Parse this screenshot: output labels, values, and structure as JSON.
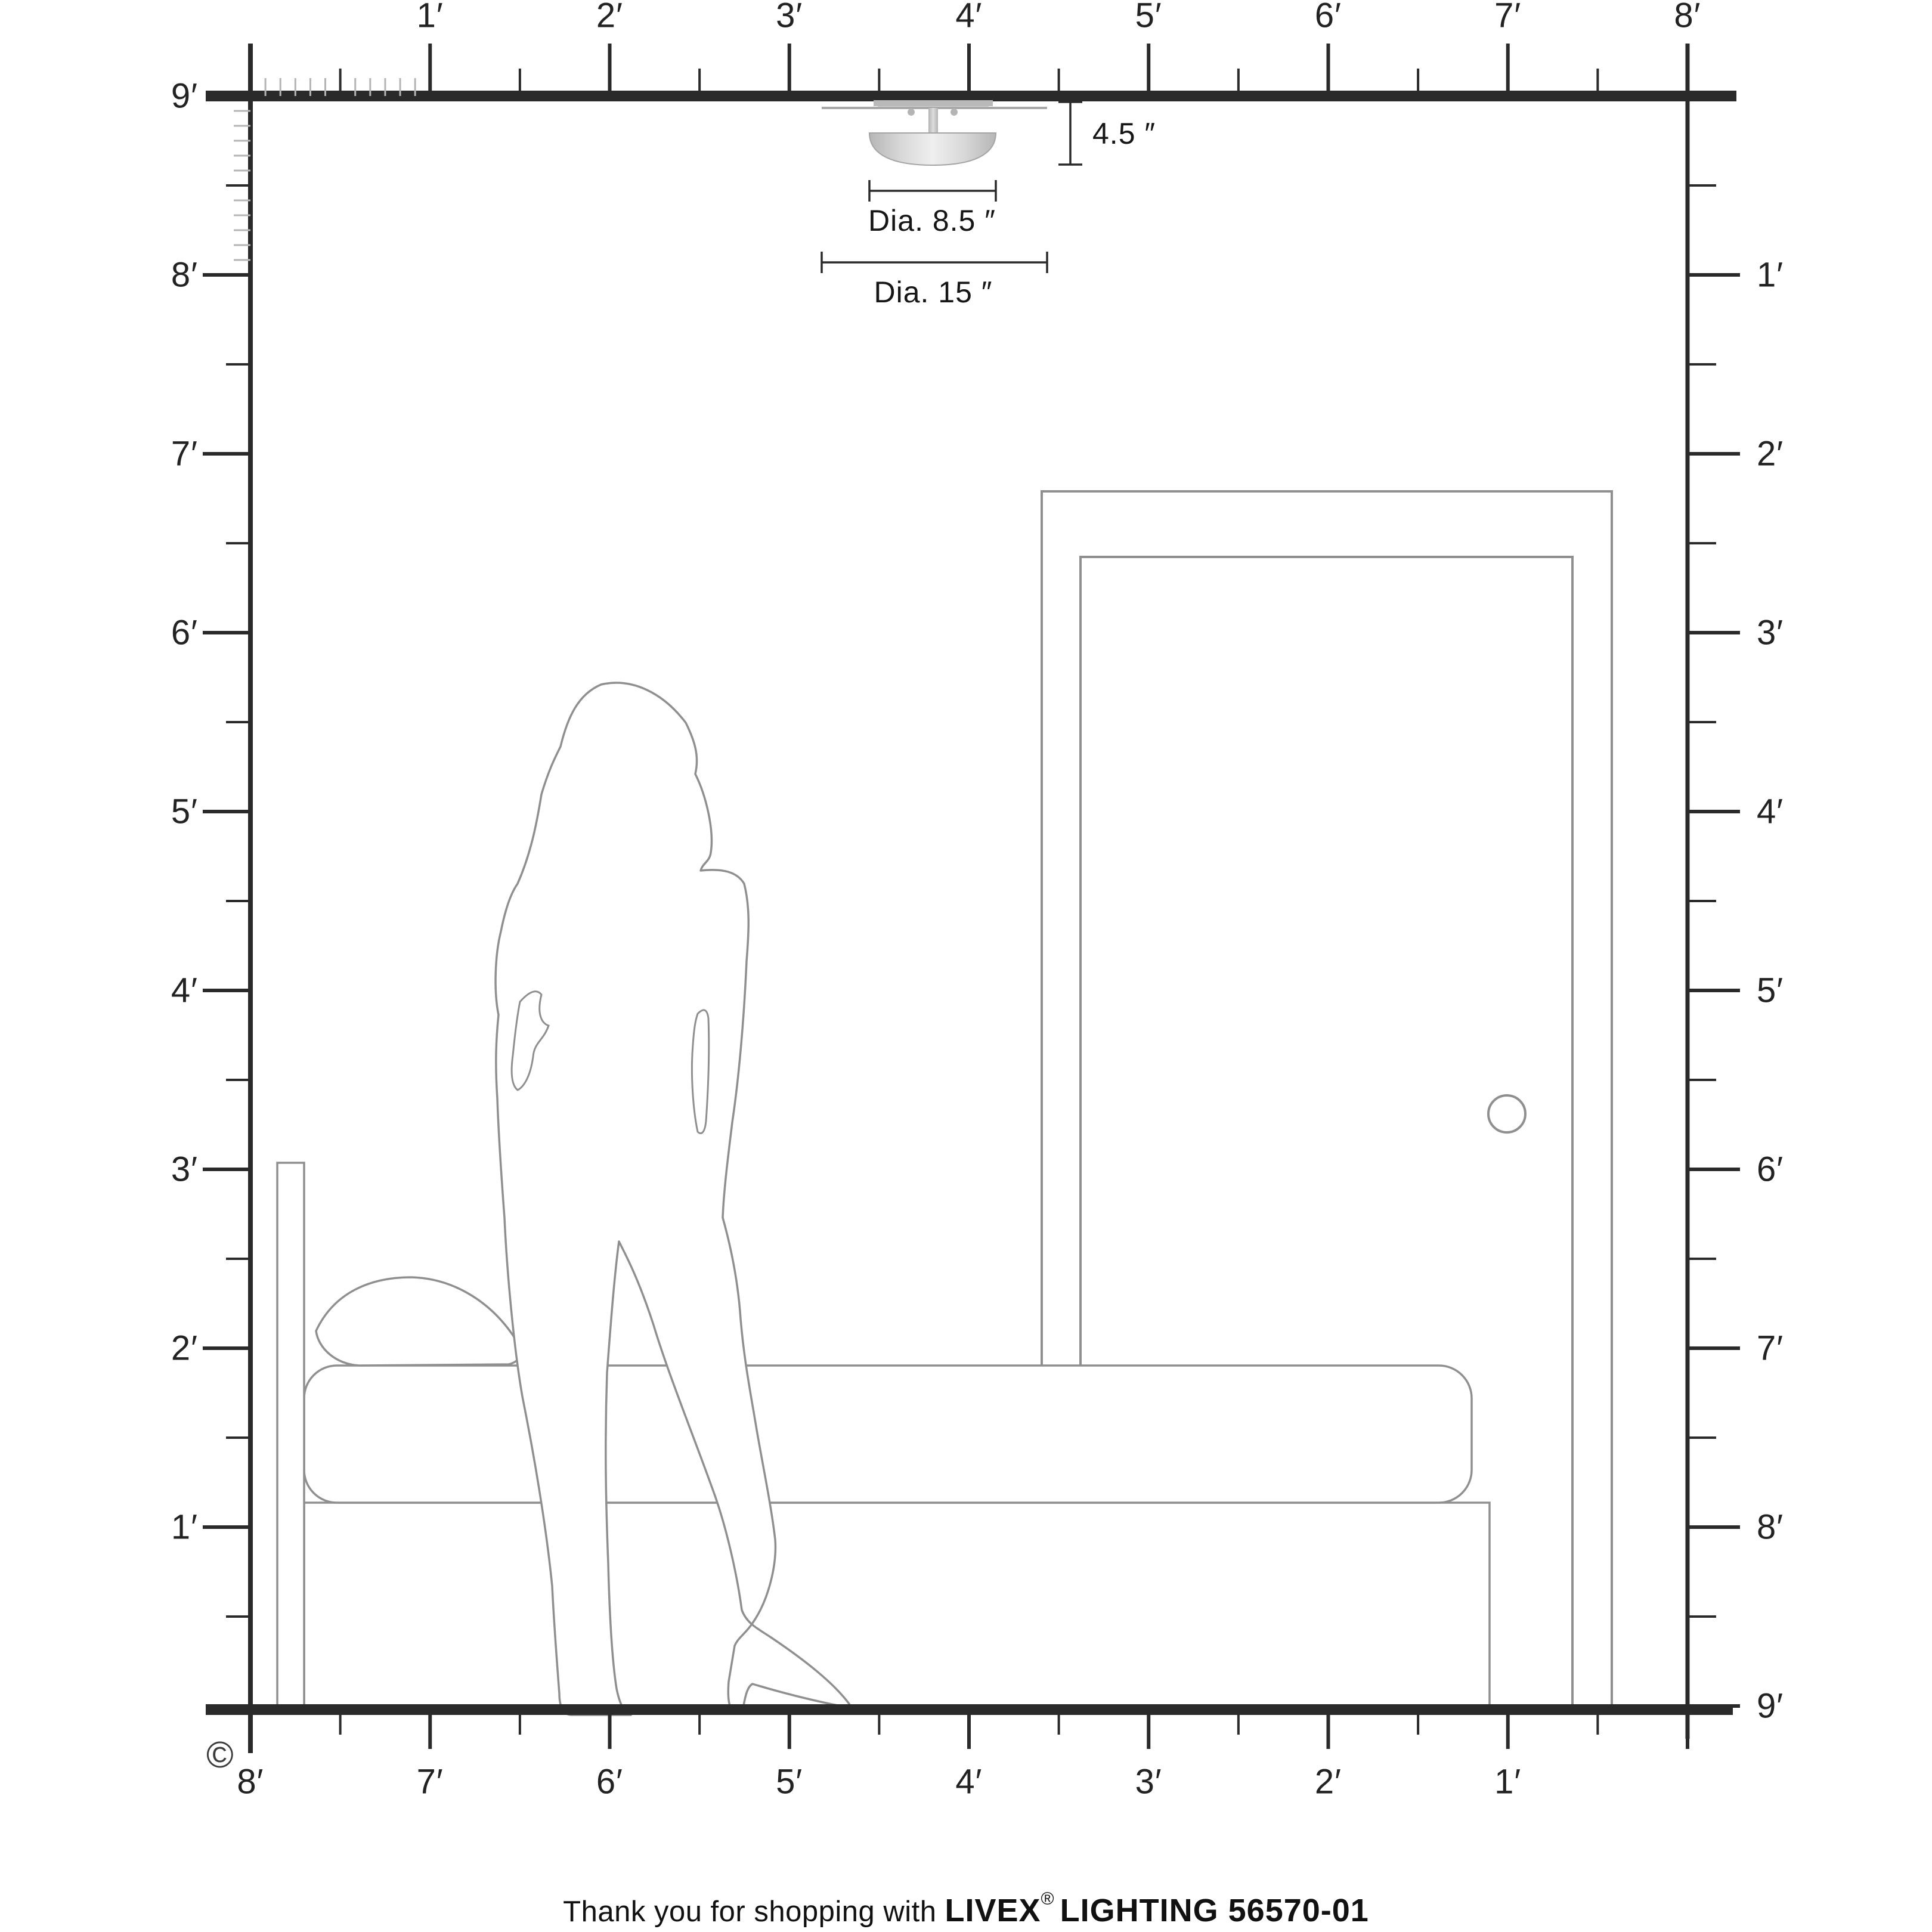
{
  "rulers": {
    "top": [
      "1′",
      "2′",
      "3′",
      "4′",
      "5′",
      "6′",
      "7′",
      "8′"
    ],
    "left": [
      "9′",
      "8′",
      "7′",
      "6′",
      "5′",
      "4′",
      "3′",
      "2′",
      "1′"
    ],
    "right": [
      "1′",
      "2′",
      "3′",
      "4′",
      "5′",
      "6′",
      "7′",
      "8′",
      "9′"
    ],
    "bottom": [
      "8′",
      "7′",
      "6′",
      "5′",
      "4′",
      "3′",
      "2′",
      "1′"
    ]
  },
  "dimensions": {
    "fixture_height": "4.5 ″",
    "glass_diameter": "Dia. 8.5 ″",
    "overall_diameter": "Dia. 15 ″"
  },
  "footer": {
    "prefix": "Thank you for shopping with",
    "brand": "LIVEX",
    "registered": "®",
    "suffix": "LIGHTING 56570-01"
  },
  "copyright": "©",
  "colors": {
    "ruler_ink": "#2a2a2a",
    "inch_tick": "#b5b5b5",
    "scene_outline": "#8f8f8f",
    "fixture_light": "#eeeeee",
    "fixture_mid": "#c9c9c9",
    "fixture_dark": "#b0b0b0",
    "text_ink": "#161616"
  }
}
